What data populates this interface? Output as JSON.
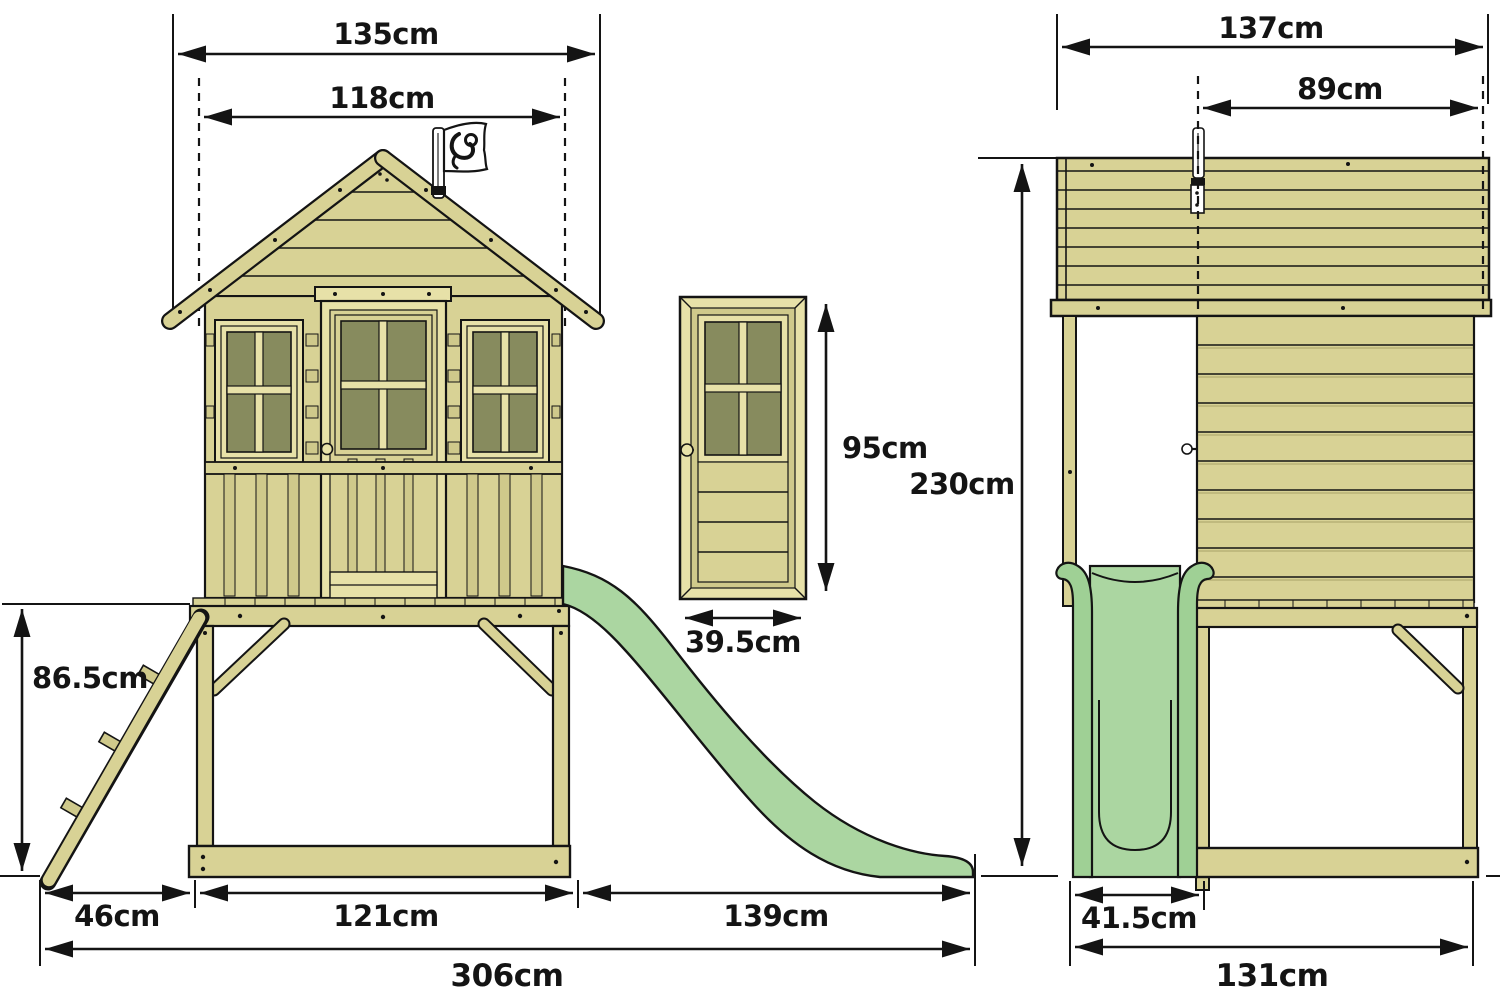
{
  "title": "playhouse-dimension-diagram",
  "colors": {
    "wood": "#d8d295",
    "wood_light": "#e7e1a8",
    "wood_mid": "#cfc98b",
    "wood_shadow": "#b1ab70",
    "glass": "#878b5e",
    "slide_green": "#9fd095",
    "slide_green_light": "#abd6a1",
    "flag_white": "#ffffff",
    "line": "#141414",
    "background": "#ffffff"
  },
  "front_view": {
    "labels": {
      "roof_width": "135cm",
      "inner_width": "118cm",
      "platform_height": "86.5cm",
      "ladder_depth": "46cm",
      "base_width": "121cm",
      "slide_length": "139cm",
      "total_length": "306cm"
    }
  },
  "door_detail": {
    "labels": {
      "height": "95cm",
      "width": "39.5cm"
    }
  },
  "side_view": {
    "labels": {
      "roof_depth": "137cm",
      "flag_to_rear": "89cm",
      "total_height": "230cm",
      "slide_width": "41.5cm",
      "base_depth": "131cm"
    }
  },
  "icons": {
    "flag_logo": "tp-monkey-flag"
  }
}
